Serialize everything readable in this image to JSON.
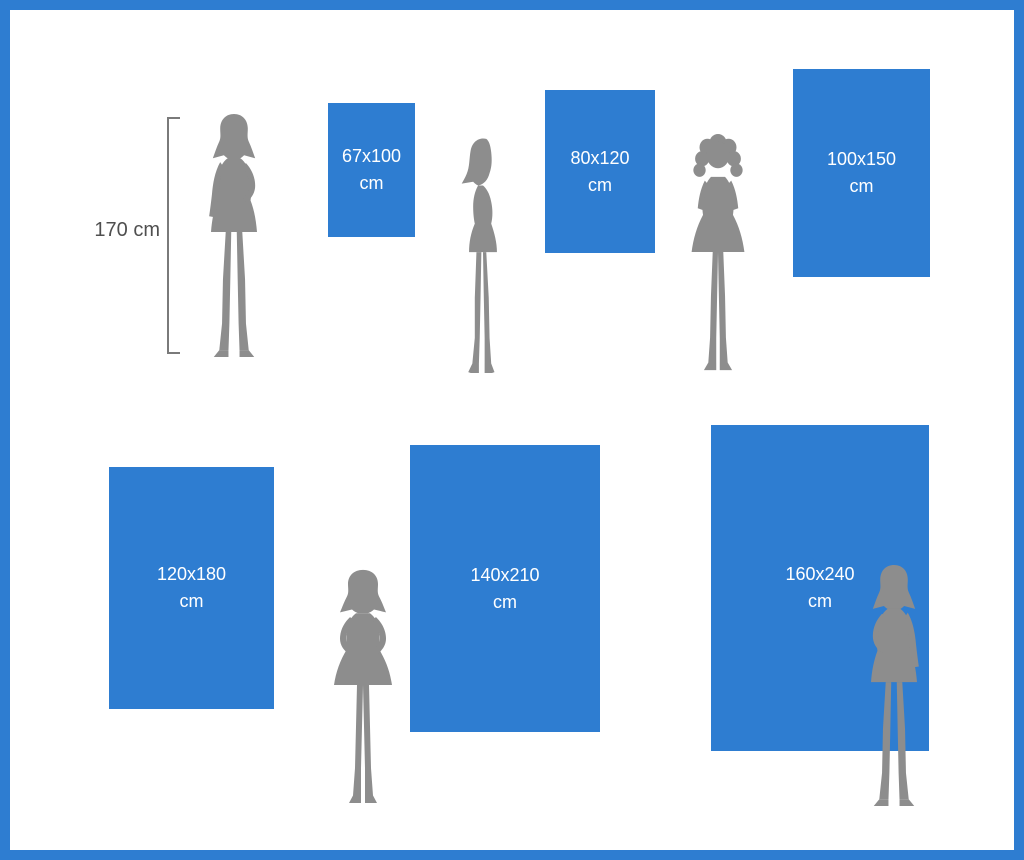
{
  "colors": {
    "frame_blue": "#2e7dd1",
    "panel_blue": "#2e7dd1",
    "label_white": "#ffffff",
    "silhouette_gray": "#8d8d8d",
    "bracket_gray": "#7a7a7a",
    "measure_text_gray": "#4f4f4f",
    "background_white": "#ffffff"
  },
  "reference": {
    "person_height_label": "170 cm"
  },
  "sizes": [
    {
      "dimensions": "67x100",
      "unit": "cm",
      "width_cm": 67,
      "height_cm": 100
    },
    {
      "dimensions": "80x120",
      "unit": "cm",
      "width_cm": 80,
      "height_cm": 120
    },
    {
      "dimensions": "100x150",
      "unit": "cm",
      "width_cm": 100,
      "height_cm": 150
    },
    {
      "dimensions": "120x180",
      "unit": "cm",
      "width_cm": 120,
      "height_cm": 180
    },
    {
      "dimensions": "140x210",
      "unit": "cm",
      "width_cm": 140,
      "height_cm": 210
    },
    {
      "dimensions": "160x240",
      "unit": "cm",
      "width_cm": 160,
      "height_cm": 240
    }
  ]
}
